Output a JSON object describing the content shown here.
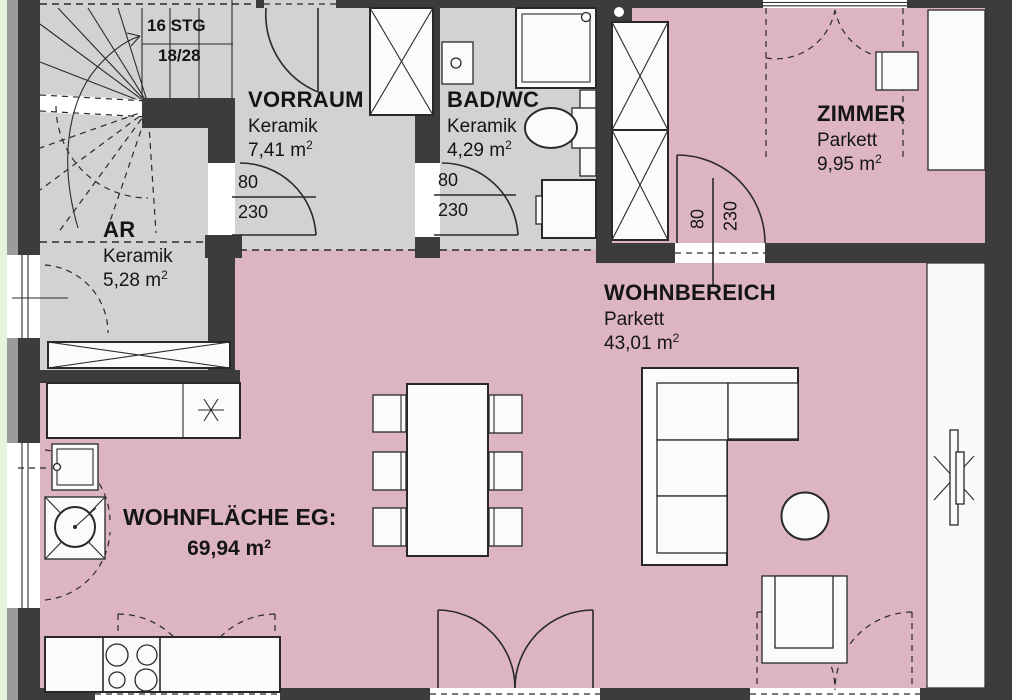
{
  "plan": {
    "stairs": {
      "line1": "16 STG",
      "line2": "18/28"
    },
    "rooms": {
      "vorraum": {
        "name": "VORRAUM",
        "floor": "Keramik",
        "area": "7,41 m",
        "area_sup": "2"
      },
      "bad": {
        "name": "BAD/WC",
        "floor": "Keramik",
        "area": "4,29 m",
        "area_sup": "2"
      },
      "zimmer": {
        "name": "ZIMMER",
        "floor": "Parkett",
        "area": "9,95 m",
        "area_sup": "2"
      },
      "ar": {
        "name": "AR",
        "floor": "Keramik",
        "area": "5,28 m",
        "area_sup": "2"
      },
      "wohnbereich": {
        "name": "WOHNBEREICH",
        "floor": "Parkett",
        "area": "43,01 m",
        "area_sup": "2"
      }
    },
    "summary": {
      "label": "WOHNFLÄCHE EG:",
      "value": "69,94 m",
      "value_sup": "2"
    },
    "doors": {
      "vorraum": {
        "width": "80",
        "height": "230"
      },
      "bad": {
        "width": "80",
        "height": "230"
      },
      "zimmer": {
        "width": "80",
        "height": "230"
      }
    },
    "colors": {
      "wall": "#3c3c3c",
      "wall_light": "#9b9b9b",
      "tile_floor": "#d2d2d2",
      "parquet_floor": "#dcb5c0",
      "outside_strip": "#e5f3dd",
      "line": "#2a2a2a"
    }
  }
}
